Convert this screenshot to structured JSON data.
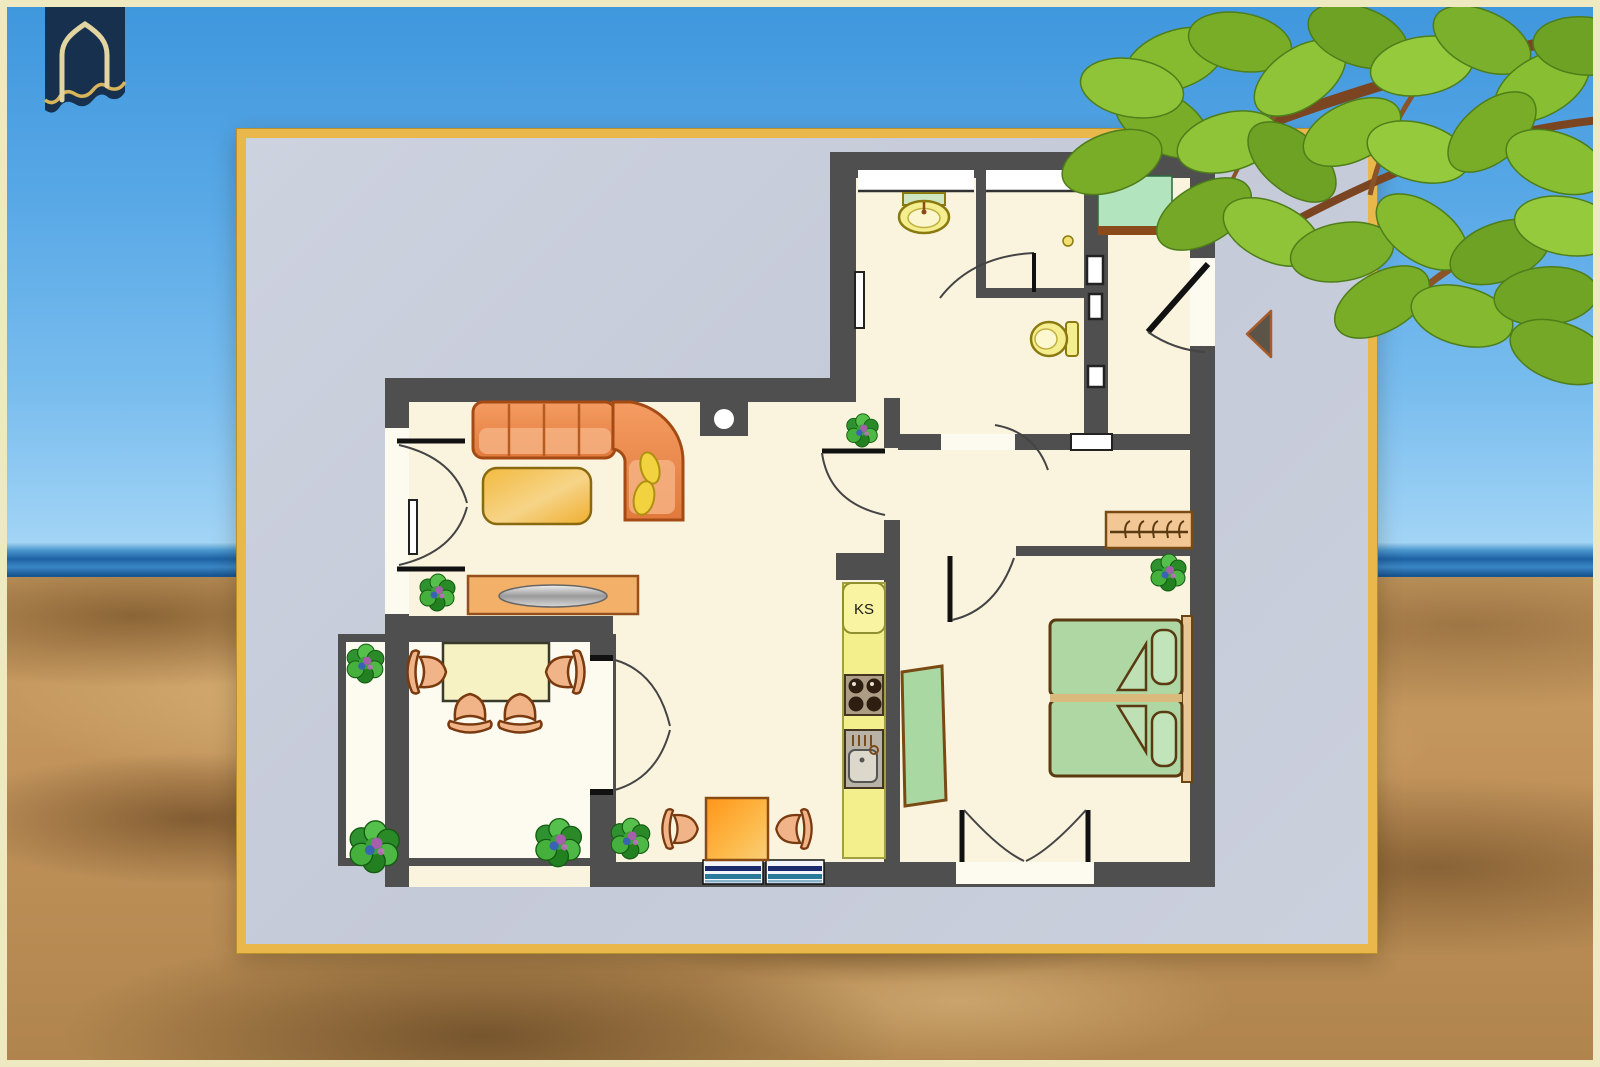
{
  "scene": {
    "frame_color": "#efe9c2",
    "sky_color": "#58a8e6",
    "ocean_color": "#1e62a4",
    "sand_color": "#c99e63",
    "foliage_color": "#7ab02c"
  },
  "logo": {
    "icon": "house-arch-icon",
    "banner_color": "#16304d",
    "outline_color": "#e3d5a2"
  },
  "card": {
    "border_color": "#e9b74a",
    "background_color": "#c7ccd9"
  },
  "floor_plan": {
    "kitchen": {
      "fridge_label": "KS"
    },
    "colors": {
      "wall": "#4f4f4f",
      "floor": "#faf4df",
      "sofa": "#ed8c52",
      "bed": "#aed7a4",
      "kitchen_unit": "#f4ef8d",
      "fixture_yellow": "#f5ee8e",
      "wood": "#f3c795",
      "plant_green": "#2f9230",
      "entry_mat": "#b2e4be",
      "window_blue": "#1a2a6a"
    },
    "markers": {
      "entrance_arrow_icon": "triangle-left-arrow"
    }
  }
}
